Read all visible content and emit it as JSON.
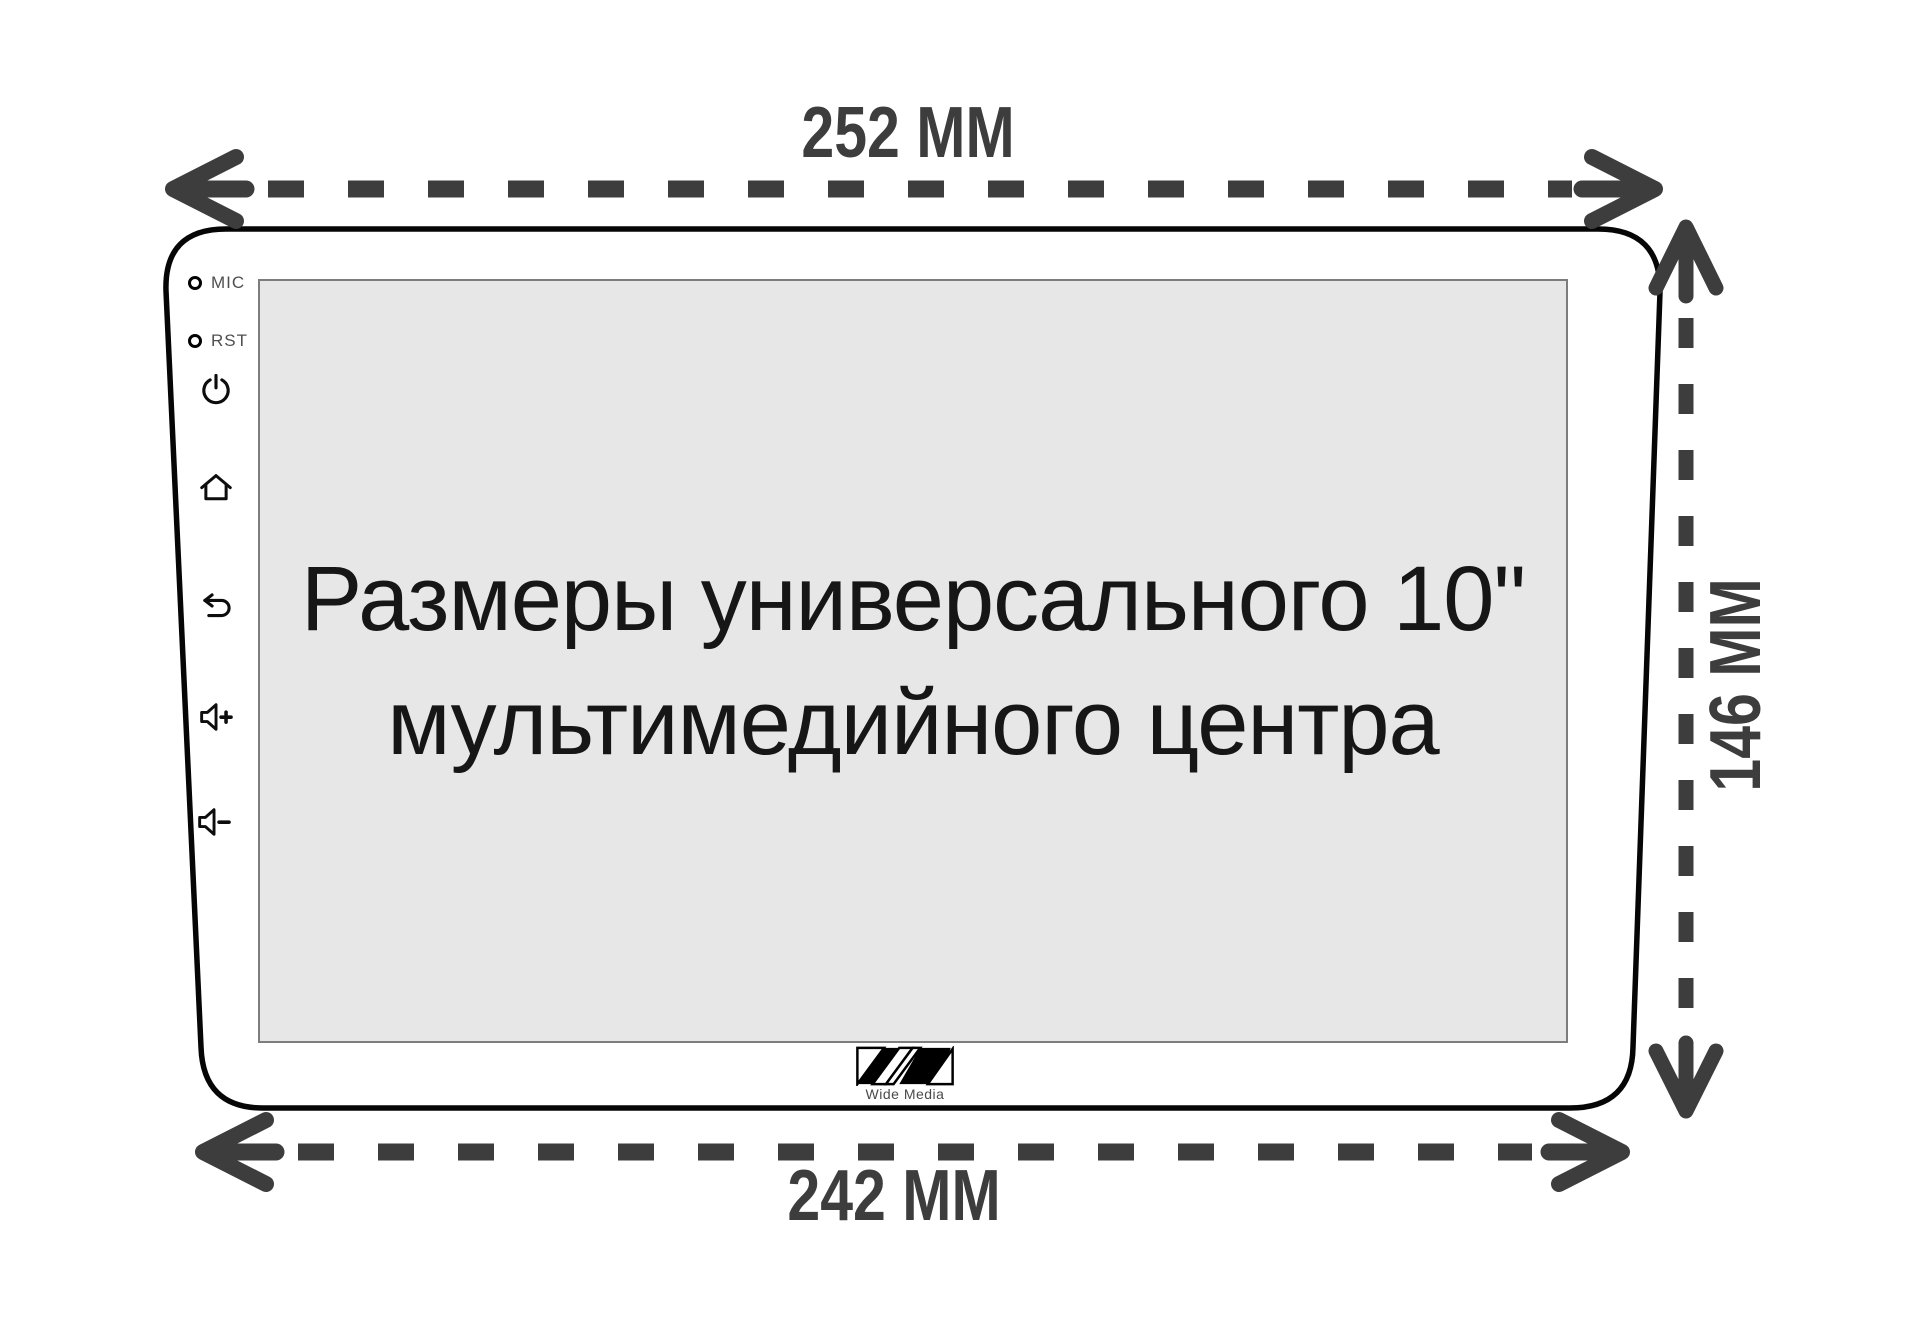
{
  "dimensions": {
    "width_top": "252 MM",
    "width_bottom": "242 MM",
    "height_right": "146 MM",
    "arrow_color": "#3d3d3d"
  },
  "device": {
    "outline_color": "#000000",
    "bezel": {
      "mic_label": "MIC",
      "rst_label": "RST",
      "buttons": [
        "power",
        "home",
        "back",
        "volume-up",
        "volume-down"
      ]
    },
    "screen": {
      "background": "#e7e7e7",
      "line1": "Размеры универсального 10\"",
      "line2": "мультимедийного центра"
    },
    "logo_text": "Wide Media"
  }
}
